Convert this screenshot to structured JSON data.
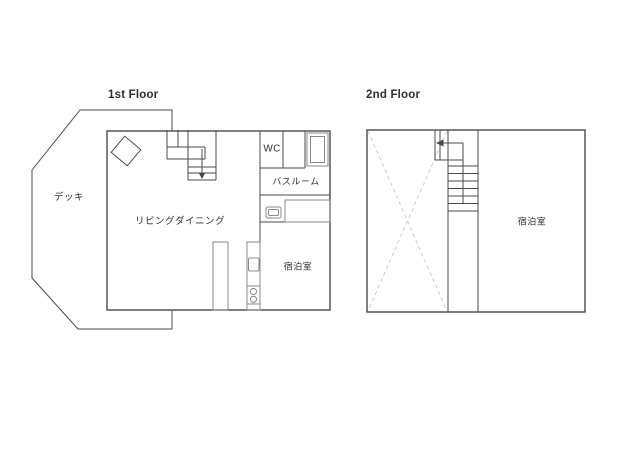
{
  "colors": {
    "background": "#ffffff",
    "wall": "#4a4a4a",
    "fixture": "#8a8a8a",
    "dash": "#cccccc",
    "text": "#2f2f2f"
  },
  "first_floor": {
    "title": "1st Floor",
    "labels": {
      "deck": "デッキ",
      "living_dining": "リビングダイニング",
      "wc": "WC",
      "bathroom": "バスルーム",
      "guest_room": "宿泊室"
    }
  },
  "second_floor": {
    "title": "2nd Floor",
    "labels": {
      "guest_room": "宿泊室"
    }
  }
}
